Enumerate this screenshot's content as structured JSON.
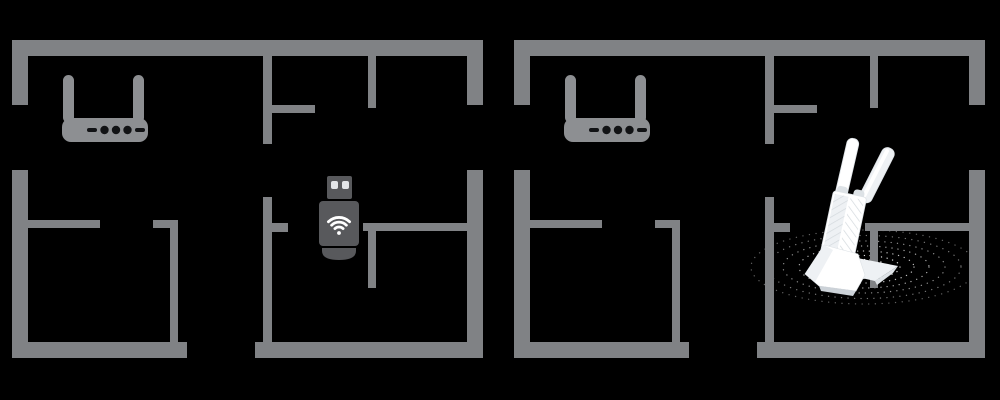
{
  "diagram": {
    "type": "wifi-coverage-comparison-floorplans",
    "panels": [
      {
        "id": "before",
        "name": "floorplan-with-usb-dongle",
        "router_icon": "wifi-router-icon",
        "device_icon": "usb-wifi-dongle-icon",
        "signal_rings": false
      },
      {
        "id": "after",
        "name": "floorplan-with-dual-antenna-adapter",
        "router_icon": "wifi-router-icon",
        "device_icon": "dual-antenna-usb-adapter-icon",
        "signal_rings": true
      }
    ]
  },
  "colors": {
    "background": "#000000",
    "wall": "#808285",
    "router": "#8d8f92",
    "router_detail": "#121315",
    "dongle_body": "#58595c",
    "dongle_detail": "#e4e6e8",
    "wifi_icon": "#ffffff",
    "device_white": "#ffffff",
    "device_shade": "#eef1f4",
    "device_hatch": "#d3d9dd",
    "device_edge": "#dde2e6",
    "signal_dots": "#ffffff"
  }
}
